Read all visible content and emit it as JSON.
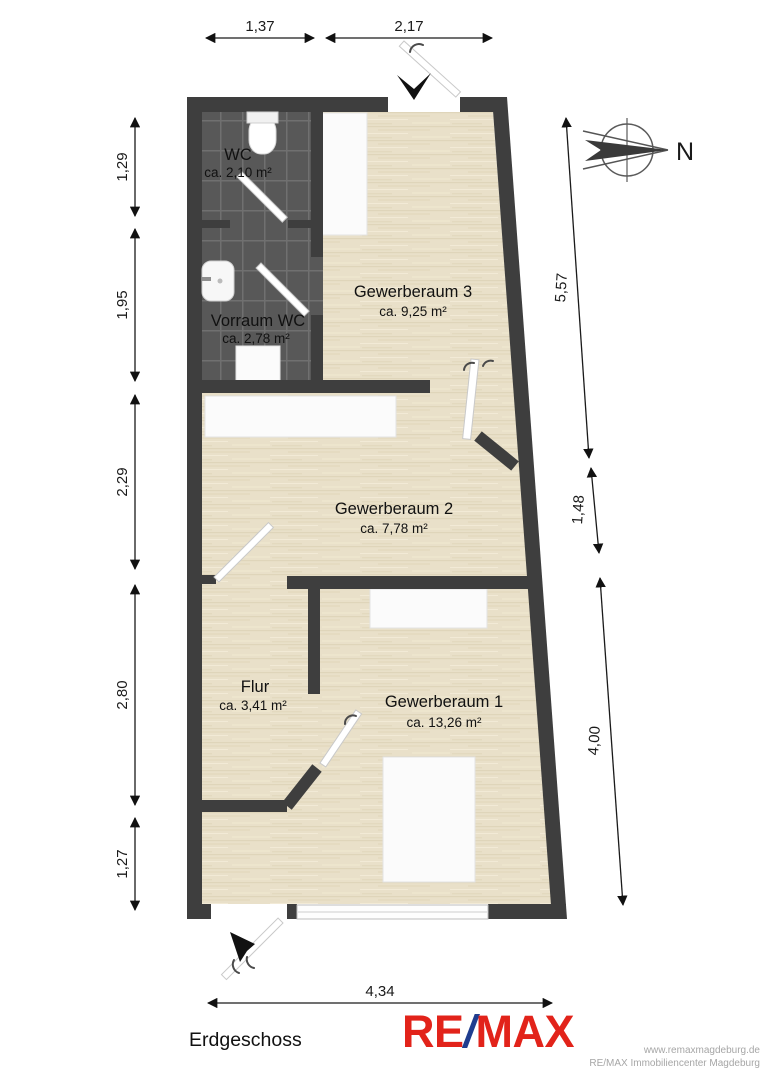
{
  "plan": {
    "floor_label": "Erdgeschoss",
    "compass_label": "N",
    "rooms": [
      {
        "name": "WC",
        "area": "ca. 2,10 m²"
      },
      {
        "name": "Vorraum WC",
        "area": "ca. 2,78 m²"
      },
      {
        "name": "Gewerberaum 3",
        "area": "ca. 9,25 m²"
      },
      {
        "name": "Gewerberaum 2",
        "area": "ca. 7,78 m²"
      },
      {
        "name": "Flur",
        "area": "ca. 3,41 m²"
      },
      {
        "name": "Gewerberaum 1",
        "area": "ca. 13,26 m²"
      }
    ],
    "dimensions": {
      "top": [
        "1,37",
        "2,17"
      ],
      "left": [
        "1,29",
        "1,95",
        "2,29",
        "2,80",
        "1,27"
      ],
      "right": [
        "5,57",
        "1,48",
        "4,00"
      ],
      "bottom": [
        "4,34"
      ]
    }
  },
  "branding": {
    "logo": {
      "re": "RE",
      "slash": "/",
      "max": "MAX",
      "red": "#e2231a",
      "blue": "#1f3d8f"
    },
    "website": "www.remaxmagdeburg.de",
    "office": "RE/MAX Immobiliencenter Magdeburg"
  },
  "colors": {
    "wall": "#3e3e3e",
    "wood_floor": "#e9e0c9",
    "tile_floor": "#585858"
  }
}
